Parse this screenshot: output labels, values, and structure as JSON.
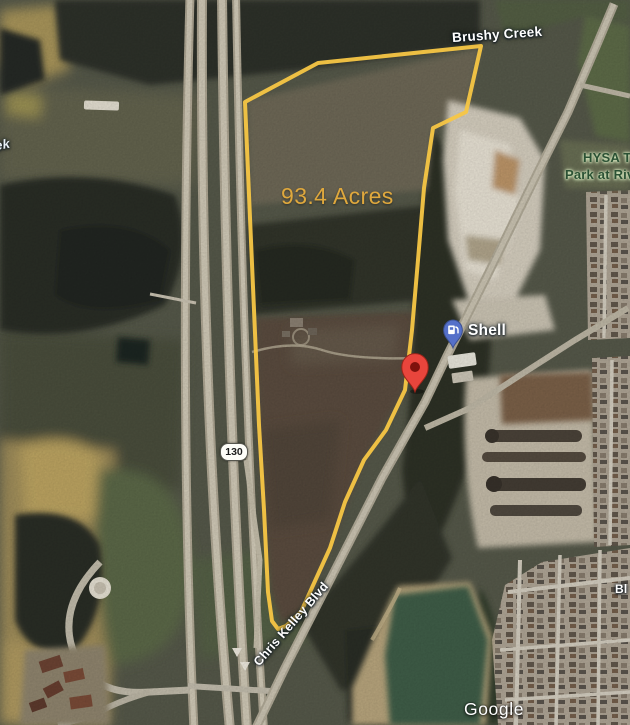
{
  "overlay": {
    "acreage": "93.4 Acres",
    "boundary_color": "#F7C644",
    "acreage_color": "#DFA83D"
  },
  "labels": {
    "creek": "Brushy Creek",
    "creek_partial": "ek",
    "park_line1": "HYSA T",
    "park_line2": "Park at Riv",
    "gas_station": "Shell",
    "road": "Chris Kelley Blvd",
    "highway_shield": "130",
    "street_partial": "Bl",
    "watermark": "Google"
  },
  "markers": {
    "red_marker": {
      "icon": "location-pin",
      "color": "#E8453C"
    },
    "gas_marker": {
      "icon": "gas-pump",
      "color": "#5570C9"
    }
  }
}
